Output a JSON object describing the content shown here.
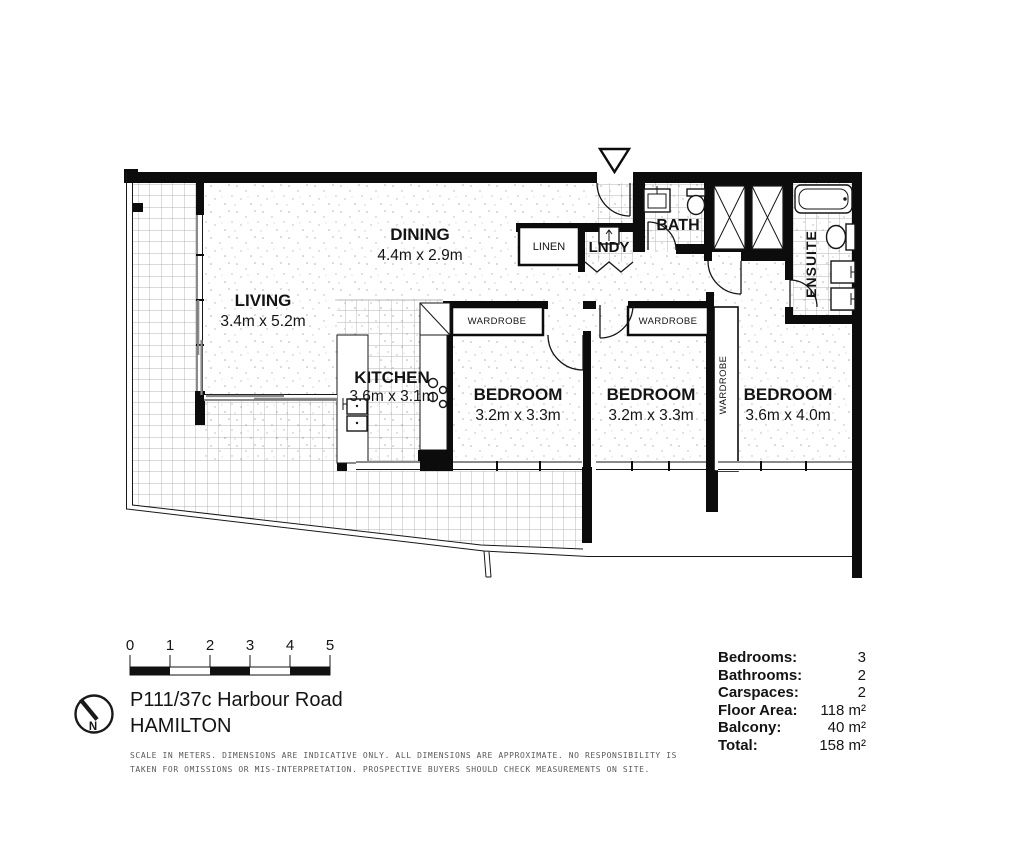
{
  "plan": {
    "rooms": {
      "living": {
        "label": "LIVING",
        "dims": "3.4m x 5.2m"
      },
      "dining": {
        "label": "DINING",
        "dims": "4.4m x 2.9m"
      },
      "kitchen": {
        "label": "KITCHEN",
        "dims": "3.6m x 3.1m"
      },
      "bedroom1": {
        "label": "BEDROOM",
        "dims": "3.2m x 3.3m"
      },
      "bedroom2": {
        "label": "BEDROOM",
        "dims": "3.2m x 3.3m"
      },
      "bedroom3": {
        "label": "BEDROOM",
        "dims": "3.6m x 4.0m"
      },
      "bath": {
        "label": "BATH"
      },
      "laundry": {
        "label": "LNDY"
      },
      "linen": {
        "label": "LINEN"
      },
      "ensuite": {
        "label": "ENSUITE"
      },
      "wardrobe1": {
        "label": "WARDROBE"
      },
      "wardrobe2": {
        "label": "WARDROBE"
      },
      "wardrobe3": {
        "label": "WARDROBE"
      }
    }
  },
  "scale_bar": {
    "unit_labels": [
      "0",
      "1",
      "2",
      "3",
      "4",
      "5"
    ]
  },
  "compass": {
    "north_label": "N"
  },
  "address": {
    "line1": "P111/37c Harbour Road",
    "line2": "HAMILTON"
  },
  "stats": {
    "rows": [
      {
        "label": "Bedrooms:",
        "value": "3"
      },
      {
        "label": "Bathrooms:",
        "value": "2"
      },
      {
        "label": "Carspaces:",
        "value": "2"
      },
      {
        "label": "Floor Area:",
        "value": "118 m²"
      },
      {
        "label": "Balcony:",
        "value": "40 m²"
      },
      {
        "label": "Total:",
        "value": "158 m²"
      }
    ]
  },
  "disclaimer": {
    "line1": "SCALE IN METERS. DIMENSIONS ARE INDICATIVE ONLY. ALL DIMENSIONS ARE APPROXIMATE. NO RESPONSIBILITY IS",
    "line2": "TAKEN FOR OMISSIONS OR MIS-INTERPRETATION. PROSPECTIVE BUYERS SHOULD CHECK MEASUREMENTS ON SITE."
  }
}
